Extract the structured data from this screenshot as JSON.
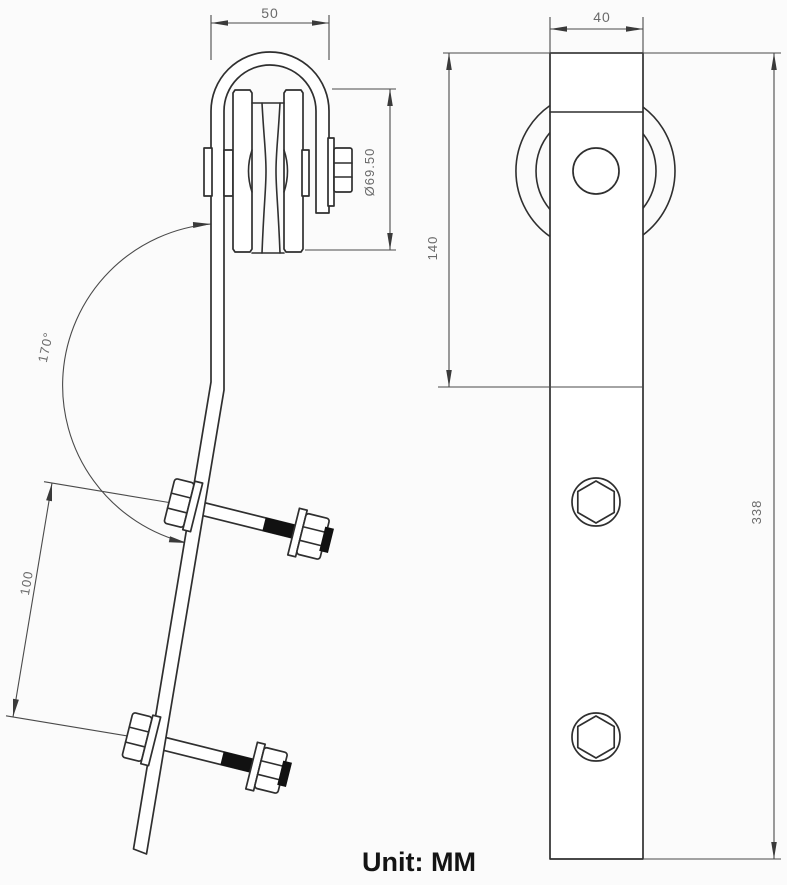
{
  "drawing": {
    "unit_note": "Unit: MM",
    "views": {
      "side_view": {
        "dimensions": {
          "yoke_outer_width": "50",
          "wheel_diameter": "Ø69.50",
          "strap_bend_angle": "170°",
          "bolt_hole_spacing": "100"
        }
      },
      "front_view": {
        "dimensions": {
          "strap_width": "40",
          "wheel_drop_height": "140",
          "hanger_total_length": "338"
        }
      }
    },
    "colors": {
      "line": "#2f2f2f",
      "dimension_line": "#4a4a4a",
      "dimension_text": "#6a6a6a",
      "thread_fill": "#111111",
      "background": "#fbfbfb"
    }
  }
}
